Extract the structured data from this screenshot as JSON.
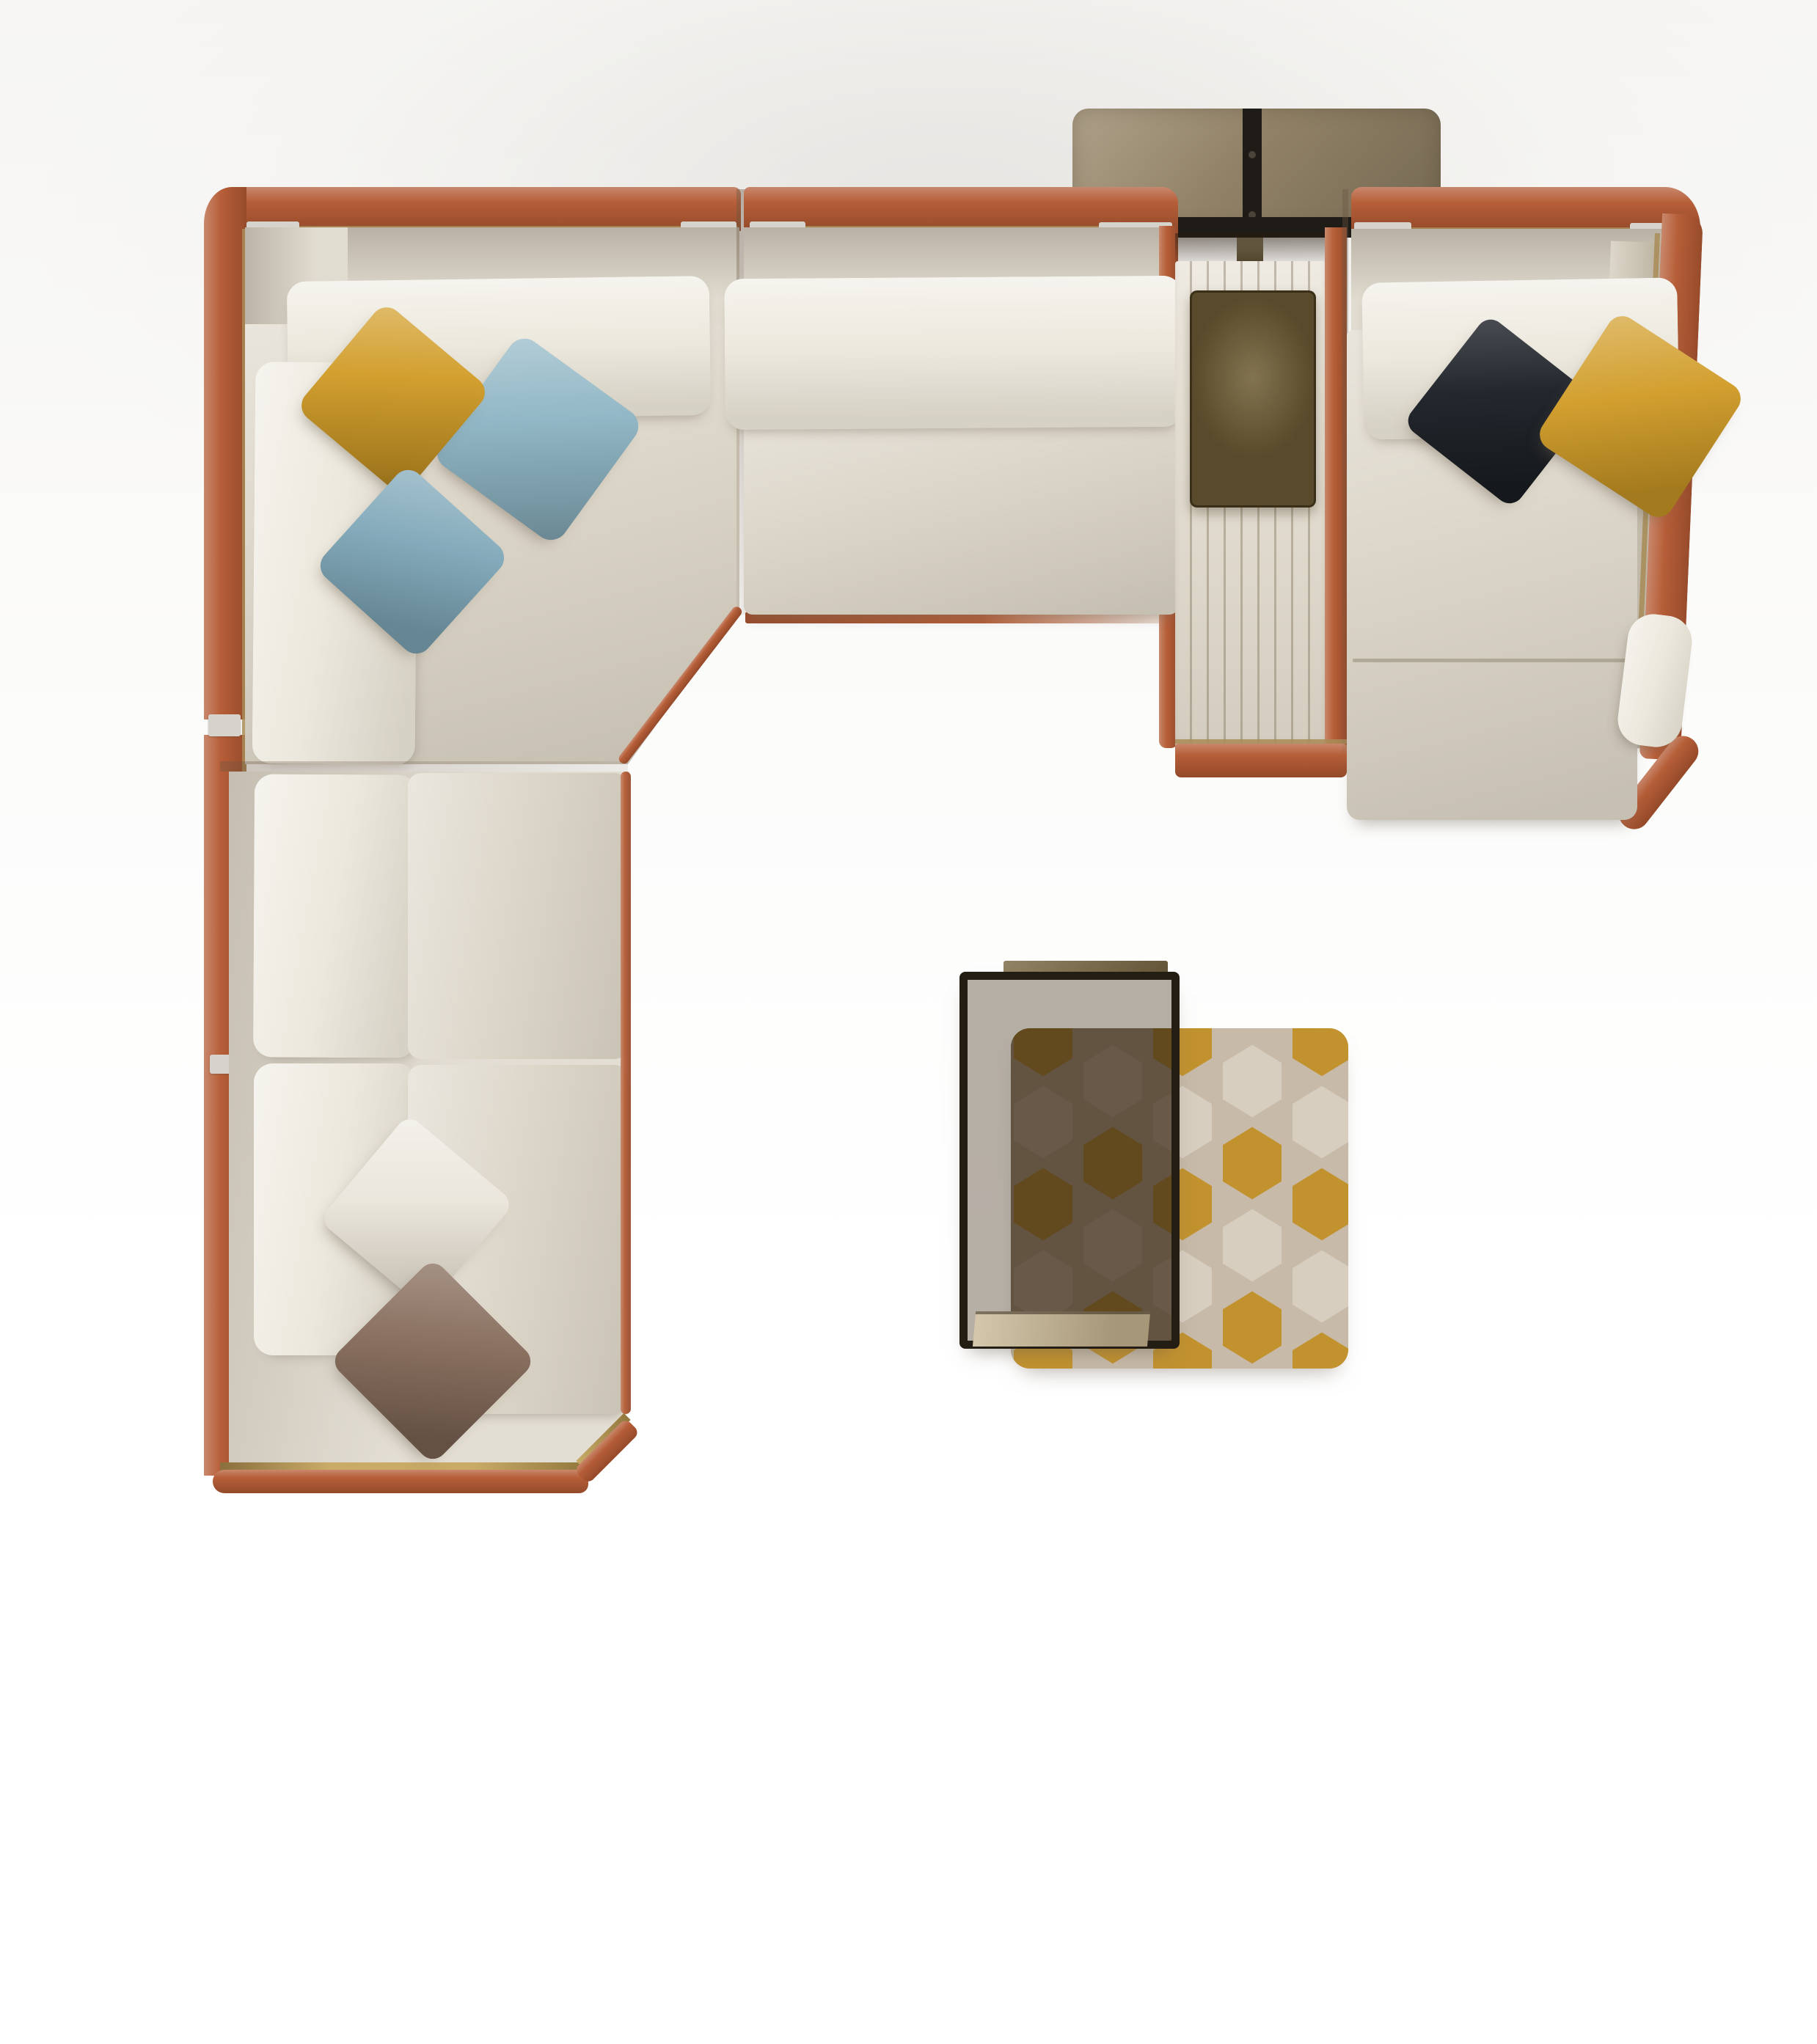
{
  "scene": {
    "type": "top-down product photograph",
    "subject": "modular sectional sofa with chaise longue, leather trim frame, quilted console with leather tray, smoked-glass console table and coffee table with patterned ottoman",
    "background": "#ffffff"
  },
  "palette": {
    "orange": "#b65e38",
    "brass": "#a98c57",
    "brassL": "#c9ab67",
    "capMetal": "#d6d3cd",
    "fabric": "#ddd7ca",
    "cushion": "#ece8dd",
    "quilt": "#e7e1d5",
    "tray": "#6e5c34",
    "bronze": "#9a8a6d",
    "metal": "#1f1b16",
    "legBrass": "#7b6a45",
    "frame": "#241d14",
    "glass": "rgba(72,54,32,0.40)",
    "glassShade": "rgba(42,28,13,0.52)",
    "shelf": "#c6b48f",
    "poufBase": "#c7baa8",
    "hexGold": "#c2922f",
    "hexPale": "#d8cec0",
    "pillowYellow": "#d19c27",
    "pillowBlue": "#8db4c3",
    "pillowBlue2": "#7fa7b8",
    "pillowBlack": "#23282e",
    "pillowWhite": "#e8e3d8",
    "pillowBrown": "#876d5c"
  },
  "items": {
    "sofa": {
      "upholstery": "light beige velvet",
      "trim": "cognac leather frame with brass inlay line",
      "modules": [
        "corner module",
        "armless middle module",
        "quilted console module with leather tray",
        "chaise longue module",
        "two armless side modules"
      ]
    },
    "pillows": [
      {
        "id": "yellow-left",
        "color": "#d19c27"
      },
      {
        "id": "blue-upper",
        "color": "#8db4c3"
      },
      {
        "id": "blue-lower",
        "color": "#7fa7b8"
      },
      {
        "id": "black-right",
        "color": "#23282e"
      },
      {
        "id": "yellow-right",
        "color": "#d19c27"
      },
      {
        "id": "white-bottom",
        "color": "#e8e3d8"
      },
      {
        "id": "brown-bottom",
        "color": "#876d5c"
      }
    ],
    "console_table": {
      "top": "smoked bronze glass",
      "strap": "black metal with rivets",
      "leg": "brass"
    },
    "coffee_table": {
      "glass": "smoked brown",
      "frame": "dark bronze metal",
      "shelf": "brushed brass"
    },
    "ottoman": {
      "pattern": "hexagonal jacquard",
      "colors": [
        "#c2922f",
        "#d8cec0",
        "#c7baa8"
      ]
    }
  }
}
